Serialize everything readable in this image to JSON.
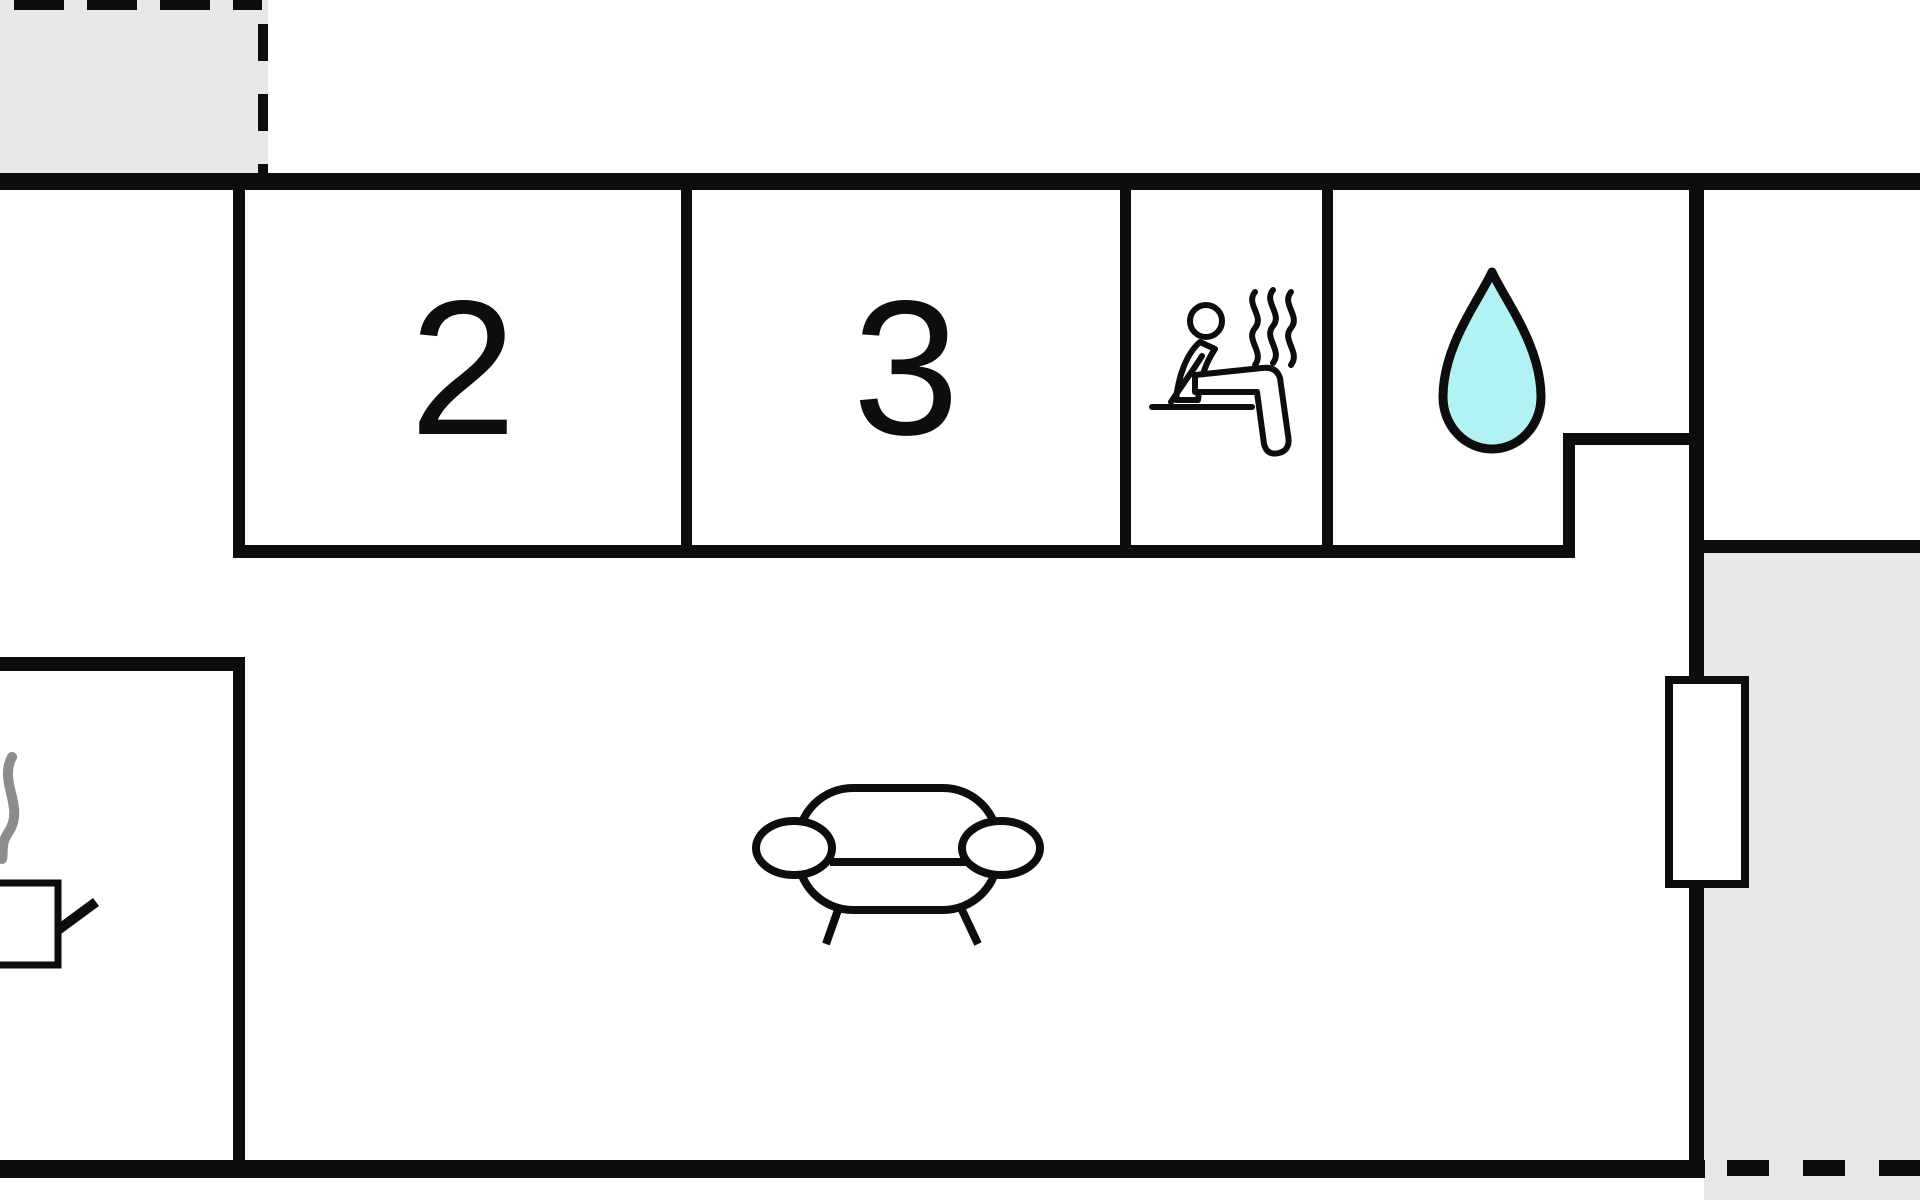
{
  "plan": {
    "title": "Holiday home floor plan",
    "rooms": {
      "bedroom_2": {
        "label": "2",
        "name": "bedroom 2"
      },
      "bedroom_3": {
        "label": "3",
        "name": "bedroom 3"
      },
      "sauna": {
        "icon": "sauna-person-icon",
        "name": "sauna"
      },
      "bathroom": {
        "icon": "water-drop-icon",
        "name": "bathroom"
      },
      "living_room": {
        "icon": "sofa-icon",
        "name": "living room"
      },
      "kitchen": {
        "icon": "stove-icon",
        "name": "kitchen corner"
      },
      "hallway": {
        "name": "hallway"
      },
      "entrance": {
        "name": "entrance"
      }
    },
    "outdoor": {
      "terrace_top_left": {
        "name": "terrace (dashed outline)"
      },
      "terrace_bottom_right": {
        "name": "terrace (dashed outline)"
      },
      "terrace_door": {
        "name": "door / window to terrace"
      }
    }
  },
  "colors": {
    "wall": "#0d0d0d",
    "terrace": "#e8e8e8",
    "drop_fill": "#b2f2f2",
    "smoke": "#8c8c8c",
    "background": "#ffffff"
  }
}
